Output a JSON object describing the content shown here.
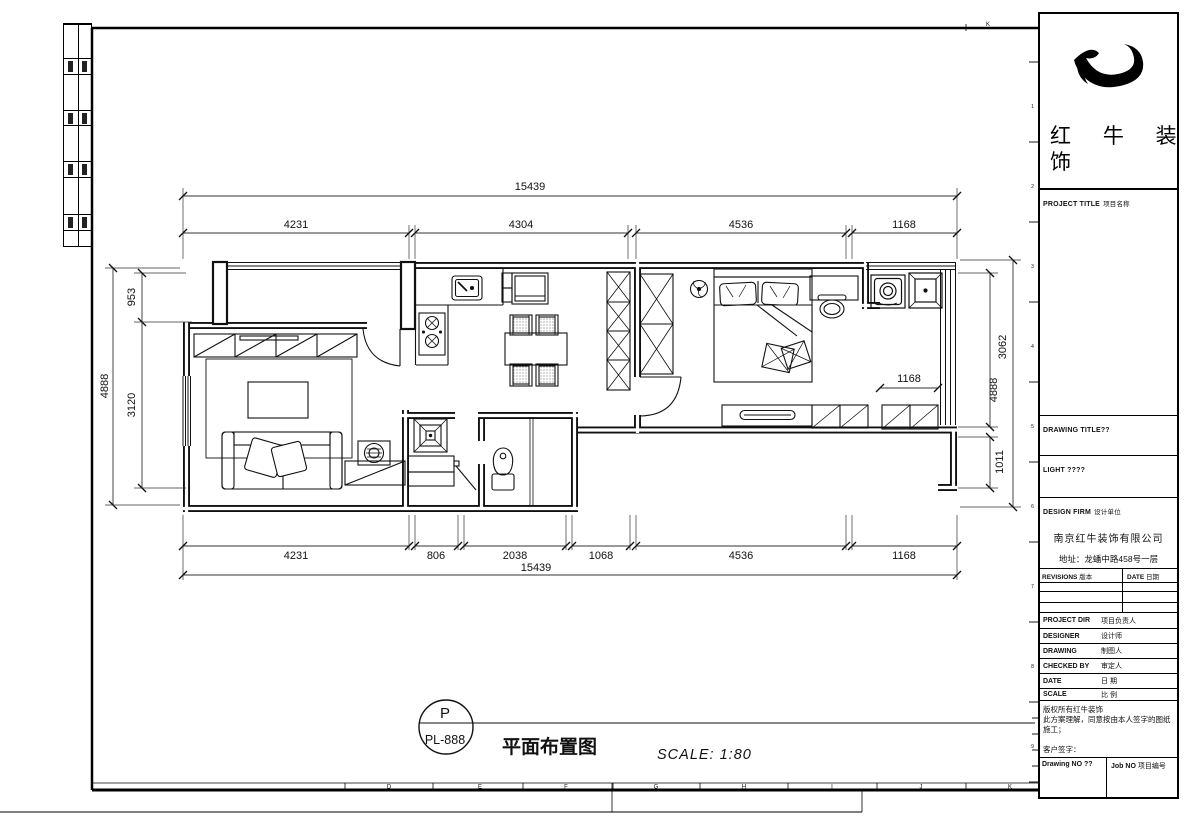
{
  "brand": {
    "logo": "bull-swoosh-logo",
    "name_line1": "红 牛 装",
    "name_line2": "饰"
  },
  "title_block": {
    "project_title_en": "PROJECT TITLE",
    "project_title_cn": "项目名称",
    "drawing_title_label": "DRAWING TITLE??",
    "light_label": "LIGHT ????",
    "design_firm_en": "DESIGN FIRM",
    "design_firm_cn": "设计单位",
    "company_name": "南京红牛装饰有限公司",
    "company_address": "地址：龙蟠中路458号一层",
    "revisions_en": "REVISIONS",
    "revisions_cn": "版本",
    "date_en": "DATE",
    "date_cn": "日期",
    "info_rows": [
      {
        "en": "PROJECT DIR",
        "cn": "项目负责人"
      },
      {
        "en": "DESIGNER",
        "cn": "设计师"
      },
      {
        "en": "DRAWING",
        "cn": "制图人"
      },
      {
        "en": "CHECKED BY",
        "cn": "审定人"
      },
      {
        "en": "DATE",
        "cn": "日 期"
      },
      {
        "en": "SCALE",
        "cn": "比 例"
      }
    ],
    "copyright_line1": "版权所有红牛装饰",
    "copyright_line2": "此方案理解，同意按由本人签字的图纸施工；",
    "customer_sign_label": "客户签字：",
    "drawing_no_label": "Drawing NO ??",
    "job_no_en": "Job NO",
    "job_no_cn": "项目编号"
  },
  "annotation": {
    "bubble_top": "P",
    "bubble_bottom": "PL-888",
    "drawing_title": "平面布置图",
    "scale_text": "SCALE: 1:80"
  },
  "dimensions": {
    "top_total": "15439",
    "top_segs": [
      "4231",
      "4304",
      "4536",
      "1168"
    ],
    "bottom_segs": [
      "4231",
      "806",
      "2038",
      "1068",
      "4536",
      "1168"
    ],
    "bottom_total": "15439",
    "left_outer": "4888",
    "left_segs": [
      "953",
      "3120"
    ],
    "right_segs": [
      "3062",
      "1011"
    ],
    "right_outer": "4888",
    "bedroom_dim": "1168"
  },
  "rulers": {
    "bottom_letters": [
      "D",
      "E",
      "F",
      "G",
      "H",
      "I",
      "J",
      "K"
    ],
    "right_numbers": [
      "1",
      "2",
      "3",
      "4",
      "5",
      "6",
      "7",
      "8",
      "9"
    ],
    "top_letter": "K"
  }
}
